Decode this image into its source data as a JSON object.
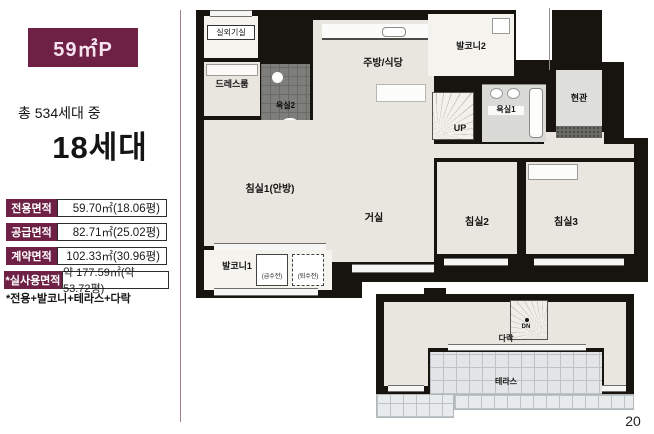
{
  "page": {
    "number": "20"
  },
  "sidebar": {
    "unit_type": "59㎡P",
    "total_line": "총 534세대 중",
    "unit_count": "18세대",
    "area_table": {
      "rows": [
        {
          "label": "전용면적",
          "value": "59.70㎡(18.06평)"
        },
        {
          "label": "공급면적",
          "value": "82.71㎡(25.02평)"
        },
        {
          "label": "계약면적",
          "value": "102.33㎡(30.96평)"
        },
        {
          "label": "*실사용면적",
          "value": "약 177.59㎡(약 53.72평)"
        }
      ]
    },
    "footnote": "*전용+발코니+테라스+다락"
  },
  "floorplan": {
    "rooms": {
      "outdoor_unit": "실외기실",
      "dress_room": "드레스룸",
      "bath2": "욕실2",
      "kitchen_dining": "주방/식당",
      "balcony2": "발코니2",
      "stair_up": "UP",
      "bath1": "욕실1",
      "entrance": "현관",
      "bedroom1": "침실1(안방)",
      "living": "거실",
      "bedroom2": "침실2",
      "bedroom3": "침실3",
      "balcony1": "발코니1",
      "supply_valve": "(급수전)",
      "drain_valve": "(퇴수전)"
    },
    "attic": {
      "loft": "다락",
      "stair_down": "DN",
      "terrace": "테라스"
    }
  },
  "colors": {
    "brand_maroon": "#6e2145",
    "wall_black": "#17130f",
    "floor_beige": "#e9e6df",
    "balcony_light": "#f4f3ee",
    "bath_tile_dark": "#7e7e7b",
    "terrace_tile": "#e3e6e7"
  }
}
